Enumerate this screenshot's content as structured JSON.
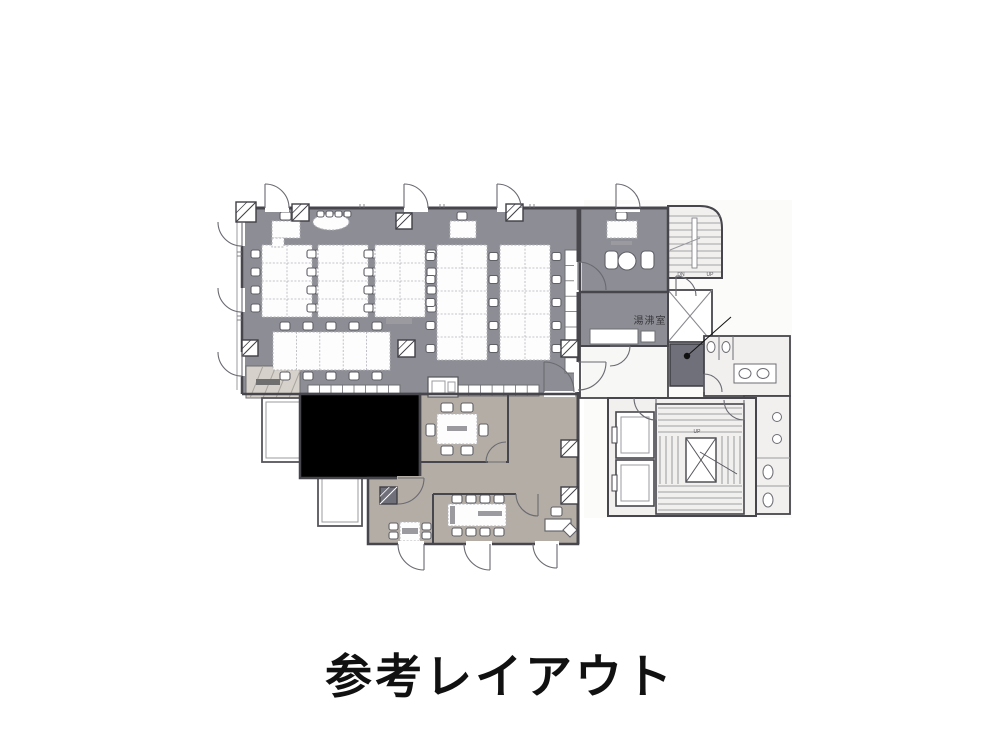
{
  "page": {
    "title": "参考レイアウト",
    "background": "#ffffff"
  },
  "floorplan": {
    "labels": {
      "kitchenette": "湯沸室",
      "stair_down": "DN",
      "stair_up": "UP",
      "core_stair_up": "UP"
    },
    "colors": {
      "office_floor": "#8d8d95",
      "conference_floor": "#a4a4a9",
      "meeting_floor": "#b4ada6",
      "core_floor": "#f1f0ee",
      "ante_floor": "#f7f7f5",
      "entrance_mat": "#d6d2cb",
      "wall": "#46464c",
      "wall_light": "#9b9ba0",
      "inner_line": "#6d6d73",
      "furniture_fill": "#fdfdfe",
      "desk_stroke": "#b2b2b8",
      "chair_stroke": "#5f5f66",
      "shaft_fill": "#70707a",
      "screen_blue": "#3d5fc0",
      "label_gray": "#9b9b9f",
      "door_stroke": "#6a6a71",
      "annotation": "#111111",
      "title_color": "#111111"
    }
  }
}
